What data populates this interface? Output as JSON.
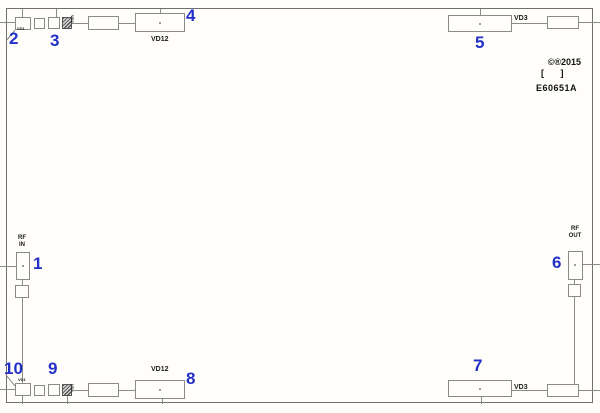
{
  "pins": {
    "p1": "1",
    "p2": "2",
    "p3": "3",
    "p4": "4",
    "p5": "5",
    "p6": "6",
    "p7": "7",
    "p8": "8",
    "p9": "9",
    "p10": "10"
  },
  "labels": {
    "vd12_top": "VD12",
    "vd12_bottom": "VD12",
    "vd3_top_right": "VD3",
    "vd3_bottom_right": "VD3",
    "vd1_top_left": "VD1",
    "vd1_bottom_left": "VD1",
    "vd2_top_left": "VD2",
    "vd2_bottom_left": "VD2"
  },
  "ports": {
    "rf_in_l1": "RF",
    "rf_in_l2": "IN",
    "rf_out_l1": "RF",
    "rf_out_l2": "OUT"
  },
  "title_block": {
    "copyright": "©®2015",
    "revision_brackets": "[ ]",
    "part_number": "E60651A"
  },
  "colors": {
    "pin_number_blue": "#2230c8",
    "trace_gray": "#8a8a8a",
    "text_black": "#1a1a1a",
    "background": "#fffefa"
  }
}
